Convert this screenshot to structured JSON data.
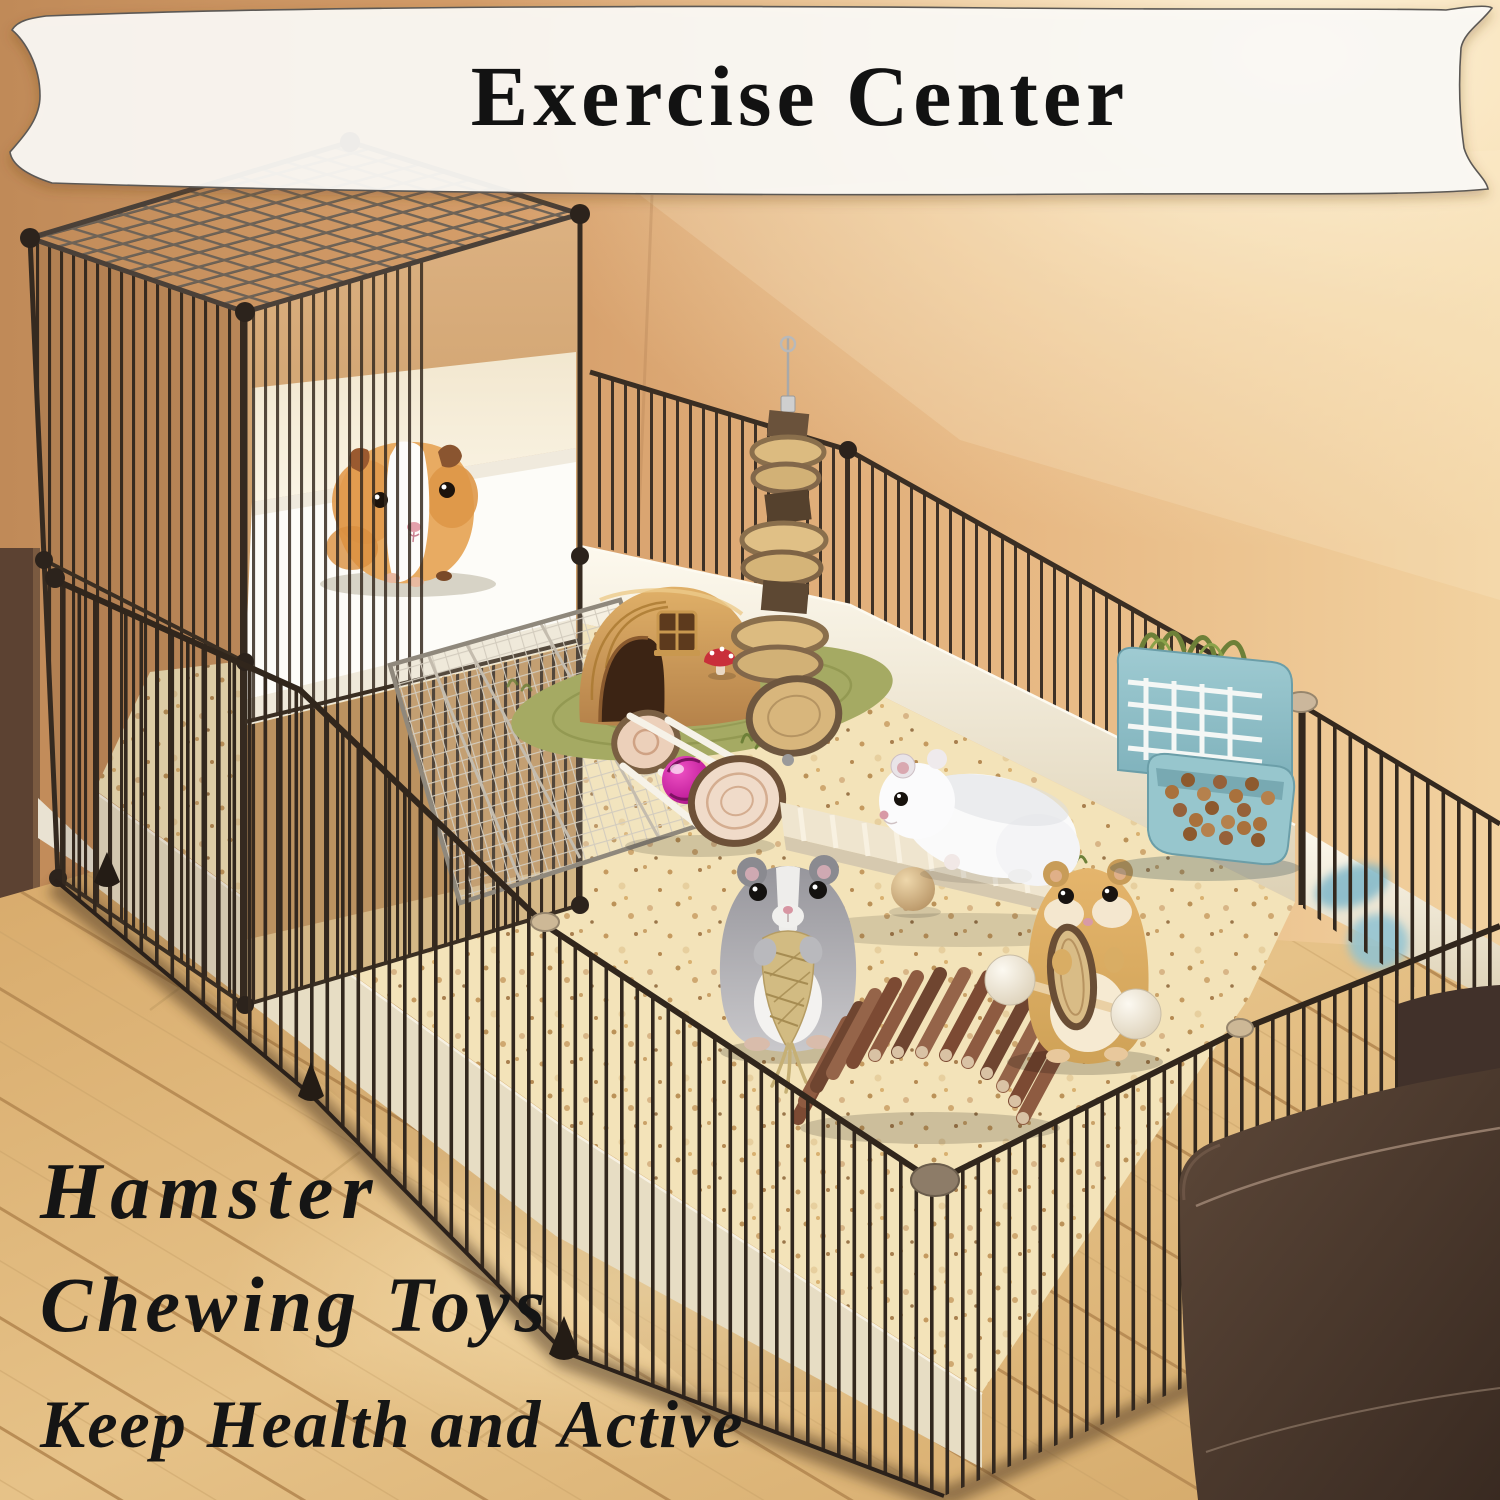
{
  "banner": {
    "title": "Exercise Center",
    "bg_color": "#FCFBF7",
    "text_color": "#121212"
  },
  "features": [
    {
      "label": "Hamster"
    },
    {
      "label": "Chewing Toys"
    },
    {
      "label": "Keep Health and Active"
    }
  ],
  "colors": {
    "wall": "#DDA874",
    "floor_wood": "#E2BC81",
    "cage_wire": "#35291F",
    "bedding": "#F3E2B6",
    "pen_trim": "#EFE6D0",
    "feeder_teal": "#8FC0C6",
    "bell_ball_magenta": "#D42FA5",
    "grass_mat_green": "#A5AA63",
    "sofa_leather": "#4A3930",
    "house_wood": "#D3A158"
  }
}
